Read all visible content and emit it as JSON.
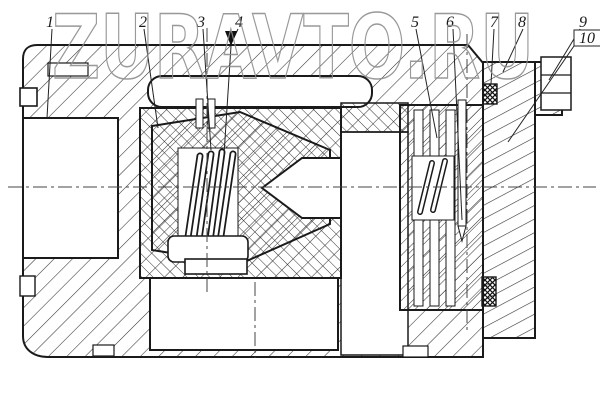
{
  "watermark": "ZURAVTO.RU",
  "callouts": [
    {
      "label": "1"
    },
    {
      "label": "2"
    },
    {
      "label": "3"
    },
    {
      "label": "4"
    },
    {
      "label": "5"
    },
    {
      "label": "6"
    },
    {
      "label": "7"
    },
    {
      "label": "8"
    },
    {
      "label": "9"
    },
    {
      "label": "10"
    }
  ],
  "colors": {
    "line": "#1a1a1a",
    "hatch": "#333333",
    "watermark_gray": "#8f8f8f",
    "paper": "#ffffff"
  }
}
